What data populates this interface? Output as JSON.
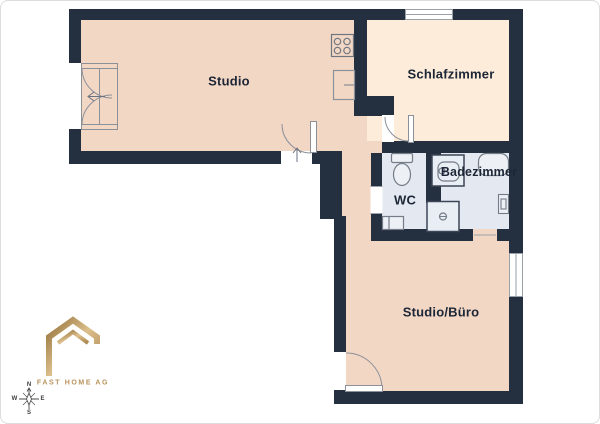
{
  "plan": {
    "rooms": [
      {
        "id": "studio",
        "label": "Studio"
      },
      {
        "id": "schlafzimmer",
        "label": "Schlafzimmer"
      },
      {
        "id": "wc",
        "label": "WC"
      },
      {
        "id": "badezimmer",
        "label": "Badezimmer"
      },
      {
        "id": "studio-buero",
        "label": "Studio/Büro"
      }
    ],
    "fixtures": [
      "stove-icon",
      "kitchen-sink-icon",
      "toilet-icon",
      "wc-sink-icon",
      "washbasin-icon",
      "shower-icon",
      "bathtub-icon",
      "bath-wall-fixture",
      "balcony-door",
      "entrance-door",
      "bedroom-door",
      "office-door",
      "window-bedroom-top",
      "window-office-right"
    ],
    "colors": {
      "wall": "#242f3f",
      "floor_main": "#f3d7c5",
      "floor_bedroom": "#fcecd9",
      "floor_bath": "#e4e8f0",
      "fixture": "#7e8590",
      "text": "#1c2636",
      "gold": "#b8935c"
    }
  },
  "compass": {
    "north": "N",
    "east": "E",
    "south": "S",
    "west": "W"
  },
  "branding": {
    "logo_text": "FAST HOME AG"
  }
}
